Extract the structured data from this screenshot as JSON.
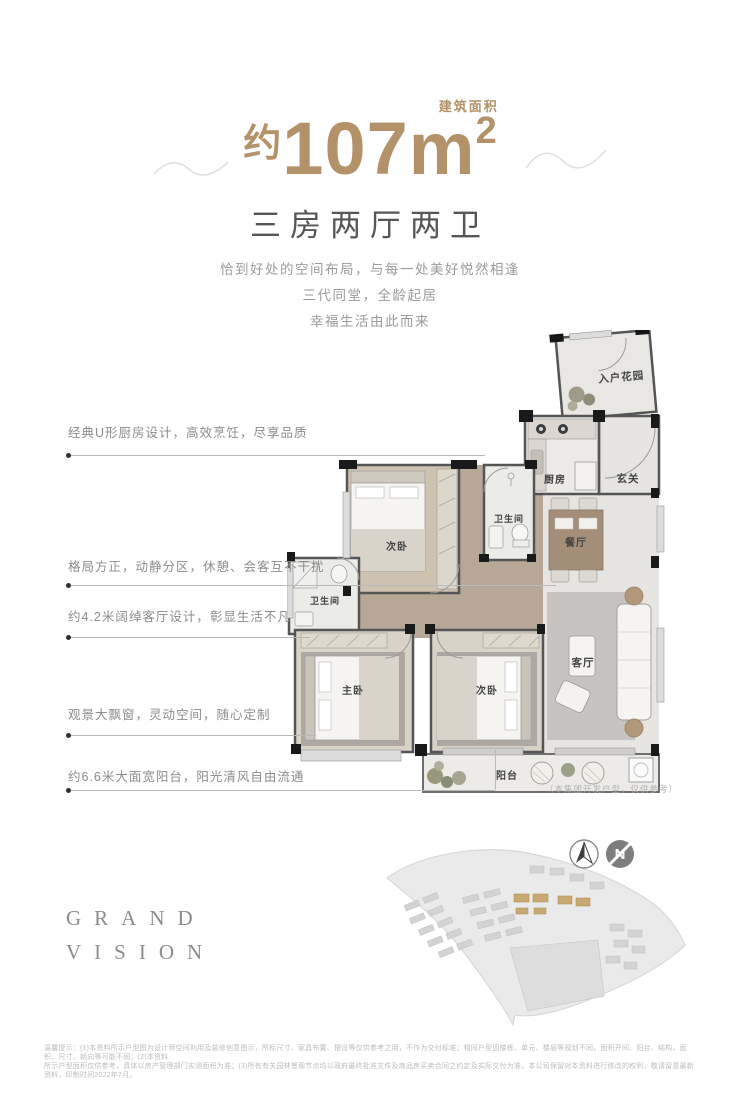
{
  "header": {
    "area_prefix": "约",
    "area_number": "107m",
    "area_sup": "2",
    "area_label": "建筑面积",
    "layout_title": "三房两厅两卫",
    "tagline1": "恰到好处的空间布局，与每一处美好悦然相逢",
    "tagline2": "三代同堂，全龄起居",
    "tagline3": "幸福生活由此而来",
    "accent_color": "#b3926a"
  },
  "callouts": {
    "c1": "经典U形厨房设计，高效烹饪，尽享品质",
    "c2": "格局方正，动静分区，休憩、会客互不干扰",
    "c3": "约4.2米阔绰客厅设计，彰显生活不凡",
    "c4": "观景大飘窗，灵动空间，随心定制",
    "c5": "约6.6米大面宽阳台，阳光清风自由流通"
  },
  "floorplan": {
    "rooms": {
      "entry_garden": "入户花园",
      "kitchen": "厨房",
      "foyer": "玄关",
      "bedroom2": "次卧",
      "bath1": "卫生间",
      "dining": "餐厅",
      "bath2": "卫生间",
      "master": "主卧",
      "bedroom3": "次卧",
      "living": "客厅",
      "balcony": "阳台"
    },
    "note": "（本集团开发户型，仅供参考）"
  },
  "branding": {
    "line1": "GRAND",
    "line2": "VISION"
  },
  "compass": {
    "letter": "N"
  },
  "disclaimer": {
    "line1": "温馨提示：(1)本资料所示户型图为设计师空间利用及装修创意图示，所标尺寸、家具布置、摆设等仅供参考之用，不作为交付标准；相同户型因楼栋、单元、楼层等规划不同，面积开间、阳台、结构、面积、尺寸、朝向等可能不同；(2)本资料",
    "line2": "所示户型面积仅供参考，具体以房产管理部门实测面积为准；(3)所有有关园林景观节点均以政府最终批准文件及商品房买卖合同之约定及实际交付为准，本公司保留对本资料进行修改的权利，敬请留意最新资料，印制时间2022年7月。"
  }
}
